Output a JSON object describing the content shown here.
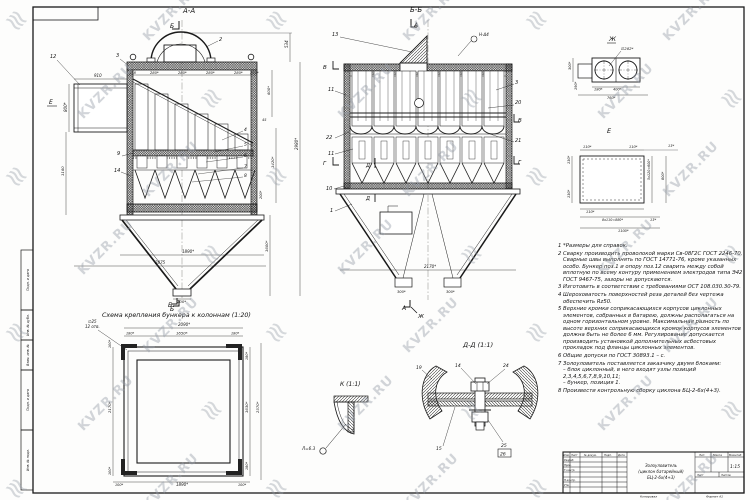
{
  "watermark": {
    "text": "KVZR.RU",
    "logo": "≋"
  },
  "frame": {
    "strip": [
      "Подп. и дата",
      "Инв. № дубл.",
      "Взам. инв. №",
      "Подп. и дата",
      "Инв. № подл."
    ]
  },
  "view_aa": {
    "title": "А-А",
    "mark_b_top": "Б",
    "mark_b_bottom": "Б",
    "mark_e": "Е",
    "top_dims": [
      "158",
      "280*",
      "280*",
      "280*",
      "280*",
      "280*"
    ],
    "c2": "2",
    "c3": "3",
    "c12": "12",
    "c9": "9",
    "c14": "14",
    "c4": "4",
    "c5": "5",
    "c6": "6",
    "c7": "7",
    "c8": "8",
    "d_inlet_w": "910",
    "d_inlet_h": "800*",
    "d_left_h": "1160",
    "d_534": "534",
    "d_600": "600*",
    "d_45": "45",
    "d_2980": "2980*",
    "d_1420": "1420*",
    "d_200": "200*",
    "d_1600": "1600*",
    "d_1890": "1890*",
    "d_2875": "2875",
    "d_outlet": "200*"
  },
  "view_bb": {
    "title": "Б-Б",
    "mark_a_top": "А",
    "mark_a_bottom": "А",
    "mark_j": "Ж",
    "weld": "Н-Δ4",
    "top_dims": [
      "158",
      "280*",
      "280*",
      "280*",
      "280*",
      "280*",
      "280*"
    ],
    "c13": "13",
    "c11a": "11",
    "c22": "22",
    "c11b": "11",
    "c10": "10",
    "c1": "1",
    "c3": "3",
    "c20": "20",
    "c21": "21",
    "v_left": "В",
    "v_right": "В",
    "g_left": "Г",
    "g_right": "Г",
    "d_top": "Д",
    "d_bottom": "Д",
    "d_2170": "2170*",
    "d_out_l": "300*",
    "d_out_r": "300*"
  },
  "detail_zh": {
    "title": "Ж",
    "d_dia": "∅282*",
    "d_300": "300*",
    "d_190": "190*",
    "d_180": "180*",
    "d_400": "400*",
    "d_760": "760*"
  },
  "detail_e": {
    "title": "Е",
    "d_t110a": "110*",
    "d_t110b": "110*",
    "d_t13": "13*",
    "d_l130a": "130*",
    "d_l130b": "130*",
    "d_r600": "5х120=600*",
    "d_r800": "800*",
    "d_b110": "110*",
    "d_b880": "8х110=880*",
    "d_b13": "13*",
    "d_b1100": "1100*"
  },
  "notes": {
    "items": [
      "1  *Размеры для справок.",
      "2  Сварку производить проволокой марки Св-08Г2С ГОСТ 2246-70. Сварные швы выполнять по ГОСТ 14771-76, кроме указанных особо. Бункер поз.1 и опору поз.12 сварить между собой вплотную по всему контуру применением электродов типа Э42 ГОСТ 9467-75, зазоры не допускаются.",
      "3  Изготовить в соответствии с требованиями ОСТ 108.030.30-79.",
      "4  Шероховатость поверхностей реза деталей без чертежа обеспечить Rz50.",
      "5  Верхние кромки соприкасающихся корпусов циклонных элементов, собранных в батарею, должны располагаться на одном горизонтальном уровне. Максимальная разность по высоте верхних соприкасающихся кромок корпусов элементов должна быть не более 6 мм. Регулирование допускается производить установкой дополнительных асбестовых прокладок под фланцы циклонных элементов.",
      "6  Общие допуски по ГОСТ 30893.1 – с.",
      "7  Золоуловитель поставляется заказчику двумя блоками:\n– блок циклонный, в него входят узлы позиций 2,3,4,5,6,7,8,9,10,11;\n– бункер, позиция 1.",
      "8  Произвести контрольную сборку циклона БЦ-2-6х(4+3)."
    ]
  },
  "scheme": {
    "title": "Схема крепления бункера к колоннам (1:20)",
    "mark_b": "Б",
    "holes_d": "∅25",
    "holes_n": "12 отв.",
    "d_top": "2090*",
    "d_t180a": "180*",
    "d_t1650": "1650*",
    "d_t180b": "180*",
    "d_l100a": "100*",
    "d_l2170": "2170*",
    "d_l100b": "100*",
    "d_r180a": "180*",
    "d_r1630": "1630*",
    "d_r180b": "180*",
    "d_r2370": "2370*",
    "d_b100a": "100*",
    "d_b1890": "1890*",
    "d_b100b": "100*"
  },
  "detail_k": {
    "title": "К (1:1)",
    "weld": "Л=6.3"
  },
  "detail_dd": {
    "title": "Д-Д (1:1)",
    "c19": "19",
    "c14": "14",
    "c24": "24",
    "c15": "15",
    "c25": "25",
    "c26": "26"
  },
  "title_block": {
    "name1": "Золоуловитель",
    "name2": "(циклон батарейный)",
    "name3": "БЦ-2-6х(4+3)",
    "scale": "1:15",
    "col_izm": "Изм.",
    "col_list": "Лист",
    "col_doc": "№ докум.",
    "col_podp": "Подп.",
    "col_data": "Дата",
    "row_razrab": "Разраб.",
    "row_prov": "Пров.",
    "row_tkontr": "Т.контр.",
    "row_nkontr": "Н.контр.",
    "row_utv": "Утв.",
    "lit": "Лит.",
    "mass": "Масса",
    "masshtab": "Масштаб",
    "list": "Лист",
    "listov": "Листов",
    "footer_copy": "Копировал",
    "footer_format": "Формат А1"
  }
}
